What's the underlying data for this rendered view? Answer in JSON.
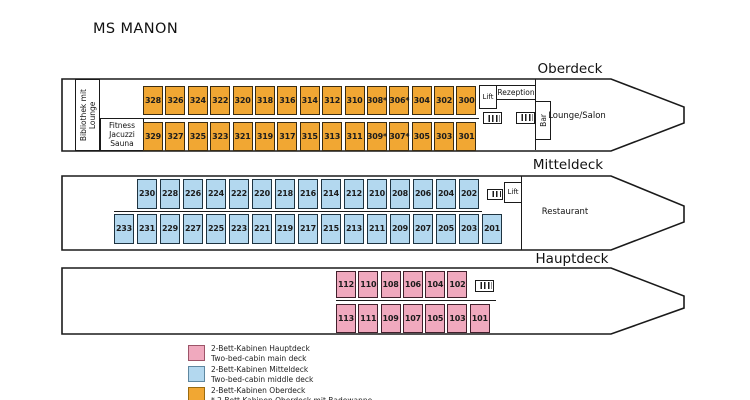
{
  "title": "MS MANON",
  "outline_color": "#1a1a1a",
  "decks": [
    {
      "id": "oberdeck",
      "label": "Oberdeck",
      "cabin_color": "#F1A733",
      "cabin_border": "#3a2c12",
      "cabins_top": [
        "328",
        "326",
        "324",
        "322",
        "320",
        "318",
        "316",
        "314",
        "312",
        "310",
        "308*",
        "306*",
        "304",
        "302",
        "300"
      ],
      "cabins_bottom": [
        "329",
        "327",
        "325",
        "323",
        "321",
        "319",
        "317",
        "315",
        "313",
        "311",
        "309*",
        "307*",
        "305",
        "303",
        "301"
      ],
      "rooms": {
        "bibliothek": "Bibliothek mit\nLounge",
        "fitness": "Fitness\nJacuzzi\nSauna",
        "lift": "Lift",
        "rezeption": "Rezeption",
        "bar": "Bar",
        "lounge": "Lounge/Salon"
      }
    },
    {
      "id": "mitteldeck",
      "label": "Mitteldeck",
      "cabin_color": "#B3D8EF",
      "cabin_border": "#1e3340",
      "cabins_top": [
        "230",
        "228",
        "226",
        "224",
        "222",
        "220",
        "218",
        "216",
        "214",
        "212",
        "210",
        "208",
        "206",
        "204",
        "202"
      ],
      "cabins_bottom": [
        "233",
        "231",
        "229",
        "227",
        "225",
        "223",
        "221",
        "219",
        "217",
        "215",
        "213",
        "211",
        "209",
        "207",
        "205",
        "203",
        "201"
      ],
      "rooms": {
        "lift": "Lift",
        "restaurant": "Restaurant"
      }
    },
    {
      "id": "hauptdeck",
      "label": "Hauptdeck",
      "cabin_color": "#F0A9BE",
      "cabin_border": "#40202c",
      "cabins_top": [
        "112",
        "110",
        "108",
        "106",
        "104",
        "102"
      ],
      "cabins_bottom": [
        "113",
        "111",
        "109",
        "107",
        "105",
        "103",
        "101"
      ]
    }
  ],
  "legend": [
    {
      "swatch_color": "#F0A9BE",
      "swatch_border": "#9C5468",
      "line1": "2-Bett-Kabinen Hauptdeck",
      "line2": "Two-bed-cabin main deck"
    },
    {
      "swatch_color": "#B3D8EF",
      "swatch_border": "#5E87A0",
      "line1": "2-Bett-Kabinen Mitteldeck",
      "line2": "Two-bed-cabin middle deck"
    },
    {
      "swatch_color": "#F1A733",
      "swatch_border": "#9A6B10",
      "line1": "2-Bett-Kabinen Oberdeck",
      "line2": "* 2-Bett Kabinen Oberdeck mit Badewanne"
    }
  ]
}
